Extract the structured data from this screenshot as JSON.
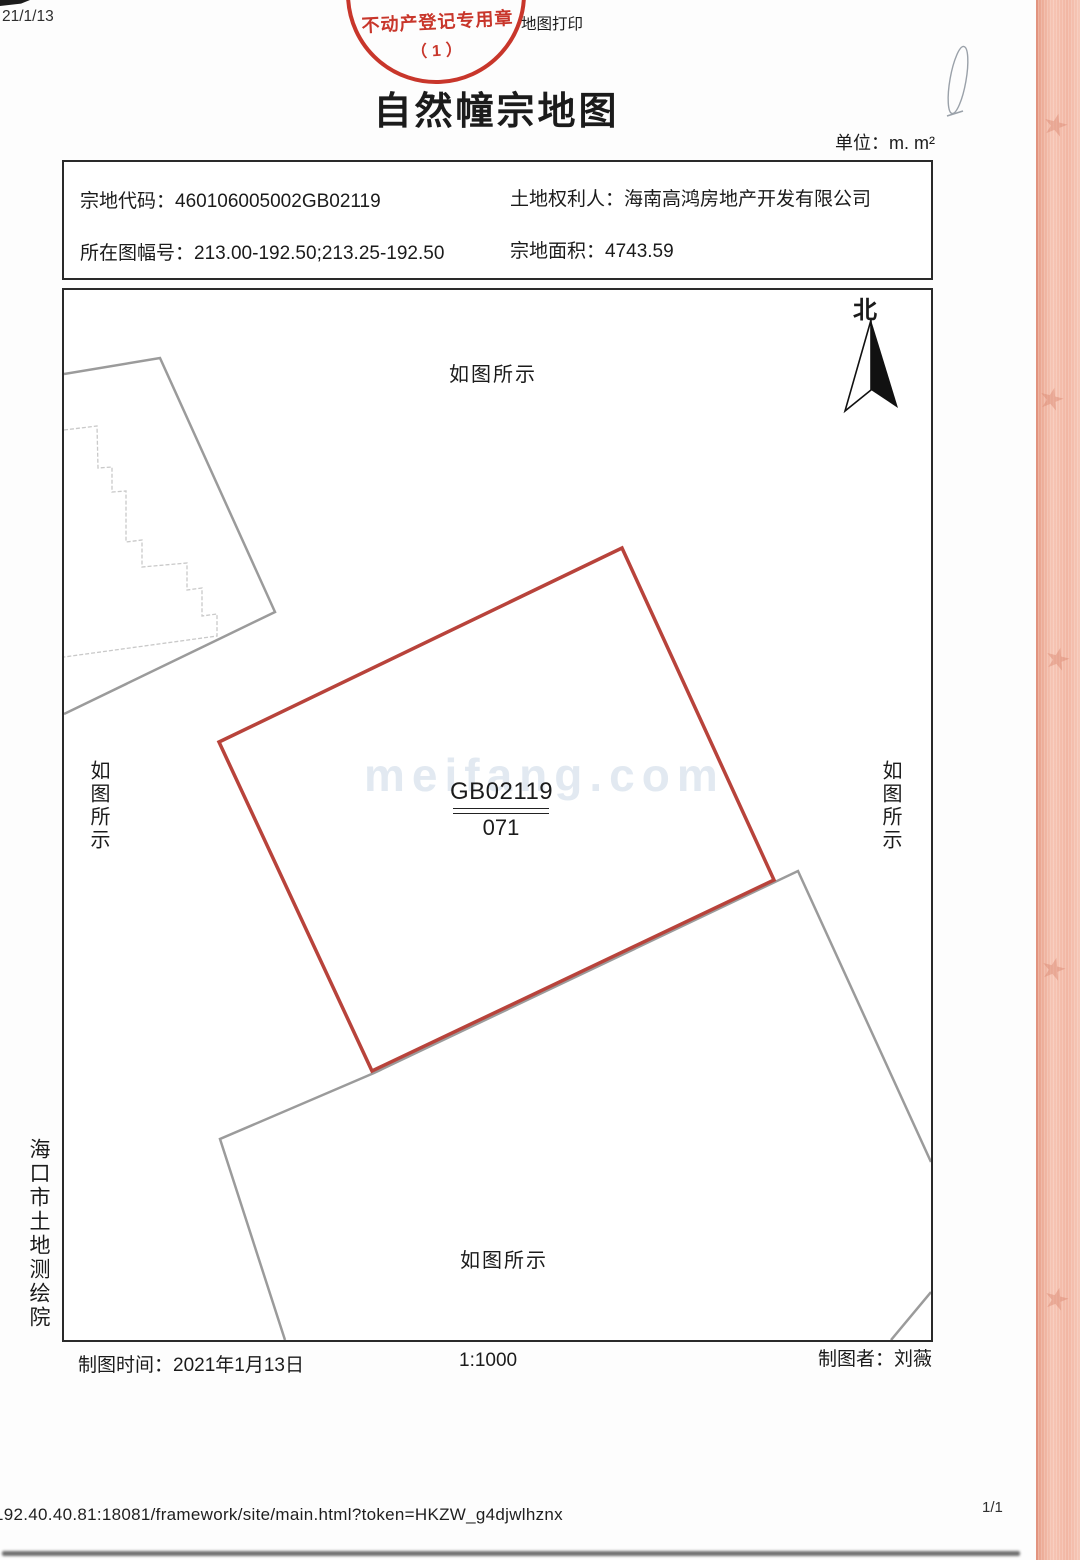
{
  "page": {
    "date_note": "21/1/13",
    "print_note": "地图打印",
    "title": "自然幢宗地图",
    "unit_note": "单位：m. m²",
    "url": "192.40.40.81:18081/framework/site/main.html?token=HKZW_g4djwlhznx",
    "page_number": "1/1"
  },
  "stamp": {
    "line1": "不动产登记专用章",
    "line2": "（1）",
    "color": "#c5281c"
  },
  "info_box": {
    "rows": [
      {
        "label": "宗地代码：",
        "value": "460106005002GB02119"
      },
      {
        "label": "土地权利人：",
        "value": "海南高鸿房地产开发有限公司"
      },
      {
        "label": "所在图幅号：",
        "value": "213.00-192.50;213.25-192.50"
      },
      {
        "label": "宗地面积：",
        "value": "4743.59"
      }
    ]
  },
  "map": {
    "north_label": "北",
    "note_top": "如图所示",
    "note_left": "如图所示",
    "note_right": "如图所示",
    "note_bottom": "如图所示",
    "parcel_code": "GB02119",
    "parcel_sublabel": "071",
    "watermark": "meifang.com",
    "parcel_color": "#b8433b",
    "neighbor_color": "#9b9b9b",
    "building_color": "#c9c9c9"
  },
  "footer": {
    "time_label": "制图时间：",
    "time_value": "2021年1月13日",
    "scale": "1:1000",
    "author_label": "制图者：",
    "author_value": "刘薇"
  },
  "institute": "海口市土地测绘院",
  "decor": {
    "star_glyph": "★"
  }
}
